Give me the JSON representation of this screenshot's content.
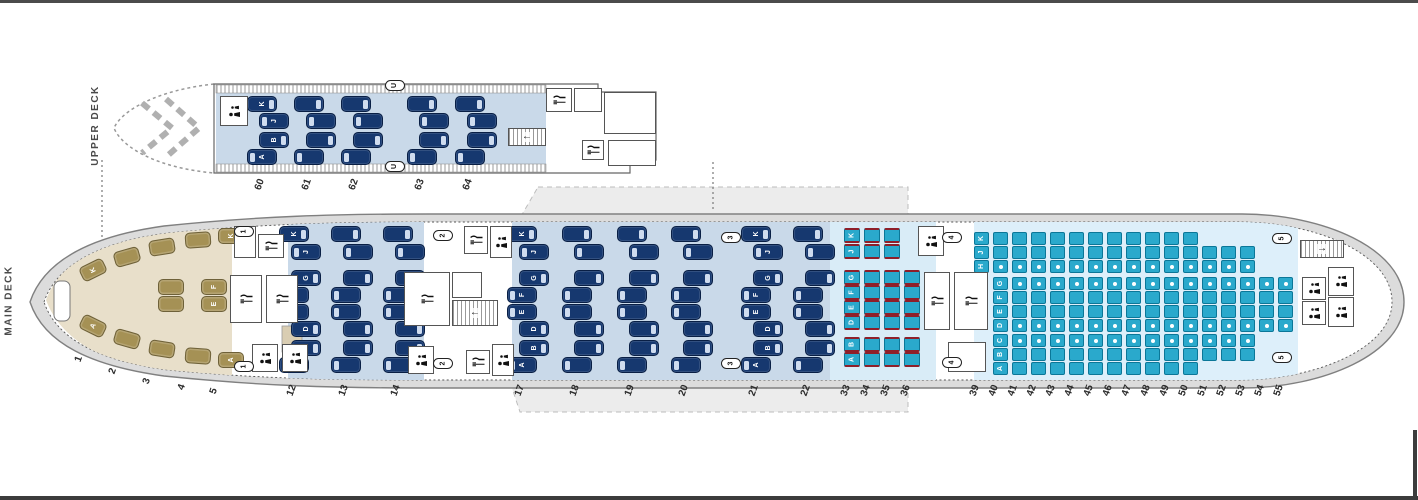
{
  "artifact_bars": {
    "top": true,
    "bottom": true,
    "right_edge": true
  },
  "seatmap": {
    "upper_deck": {
      "label": "UPPER DECK",
      "business": {
        "cabin": "Business",
        "rows": [
          60,
          61,
          62,
          63,
          64
        ],
        "letter_row": 60,
        "blocks": [
          {
            "position": "top",
            "letters": [
              "K",
              "J"
            ]
          },
          {
            "position": "bottom",
            "letters": [
              "B",
              "A"
            ]
          }
        ]
      }
    },
    "main_deck": {
      "label": "MAIN DECK",
      "first": {
        "cabin": "First",
        "rows": [
          1,
          2,
          3,
          4,
          5
        ],
        "window_top_letter": "K",
        "window_bottom_letter": "A",
        "middle_letters": [
          "F",
          "E"
        ],
        "middle_pair_rows": [
          4,
          5
        ]
      },
      "business_front": {
        "cabin": "Business",
        "rows": [
          12,
          13,
          14
        ],
        "letter_rows": [
          12
        ],
        "blocks": [
          {
            "position": "top",
            "letters": [
              "K",
              "J"
            ]
          },
          {
            "position": "middle",
            "letters": [
              "G",
              "F",
              "E",
              "D"
            ]
          },
          {
            "position": "bottom",
            "letters": [
              "B",
              "A"
            ]
          }
        ]
      },
      "business_mid": {
        "cabin": "Business",
        "rows": [
          17,
          18,
          19,
          20,
          21,
          22
        ],
        "letter_rows": [
          17,
          21
        ],
        "blocks": [
          {
            "position": "top",
            "letters": [
              "K",
              "J"
            ]
          },
          {
            "position": "middle",
            "letters": [
              "G",
              "F",
              "E",
              "D"
            ]
          },
          {
            "position": "bottom",
            "letters": [
              "B",
              "A"
            ]
          }
        ]
      },
      "premium_economy": {
        "cabin": "Premium Economy",
        "letter_row": 33,
        "blocks": [
          {
            "position": "top",
            "letters": [
              "K",
              "J"
            ],
            "rows": [
              33,
              34,
              35
            ]
          },
          {
            "position": "middle",
            "letters": [
              "G",
              "F",
              "E",
              "D"
            ],
            "rows": [
              33,
              34,
              35,
              36
            ]
          },
          {
            "position": "bottom",
            "letters": [
              "B",
              "A"
            ],
            "rows": [
              33,
              34,
              35,
              36
            ]
          }
        ]
      },
      "economy": {
        "cabin": "Economy",
        "blocks": [
          {
            "position": "top",
            "letters": [
              "K",
              "J",
              "H"
            ],
            "letter_row": 39,
            "full_rows": [
              40,
              41,
              42,
              43,
              44,
              45,
              46,
              47,
              48,
              49,
              50
            ],
            "reduced_rows": [
              51,
              52,
              53
            ],
            "reduced_letters": [
              "J",
              "H"
            ],
            "aisle_dot_letters": [
              "H"
            ]
          },
          {
            "position": "middle",
            "letters": [
              "G",
              "F",
              "E",
              "D"
            ],
            "letter_row": 40,
            "full_rows": [
              41,
              42,
              43,
              44,
              45,
              46,
              47,
              48,
              49,
              50,
              51,
              52,
              53,
              54,
              55
            ],
            "reduced_rows": [],
            "reduced_letters": [],
            "aisle_dot_letters": [
              "G",
              "D"
            ]
          },
          {
            "position": "bottom",
            "letters": [
              "C",
              "B",
              "A"
            ],
            "letter_row": 40,
            "full_rows": [
              41,
              42,
              43,
              44,
              45,
              46,
              47,
              48,
              49,
              50
            ],
            "reduced_rows": [
              51,
              52,
              53
            ],
            "reduced_letters": [
              "C",
              "B"
            ],
            "aisle_dot_letters": [
              "C"
            ]
          }
        ]
      }
    },
    "doors": [
      {
        "label": "1"
      },
      {
        "label": "1"
      },
      {
        "label": "2"
      },
      {
        "label": "2"
      },
      {
        "label": "3"
      },
      {
        "label": "3"
      },
      {
        "label": "4"
      },
      {
        "label": "4"
      },
      {
        "label": "5"
      },
      {
        "label": "5"
      },
      {
        "label": "U"
      },
      {
        "label": "U"
      }
    ],
    "icons": {
      "galley": "fork-knife-icon",
      "lavatory": "person-icon",
      "stairs": "staircase-icon"
    },
    "colors": {
      "economy_seat": "#2aa9cc",
      "economy_seat_border": "#0b7798",
      "premium_headrest": "#8e1f2a",
      "business_seat": "#16386f",
      "first_seat": "#a59155",
      "cabin_business_bg": "#c9d9e9",
      "cabin_premium_bg": "#d9ecf7",
      "cabin_economy_bg": "#ddeffa",
      "cabin_first_bg": "#e8dfca",
      "fuselage_ring": "#dcdcdc",
      "wing_shadow": "#ececec"
    }
  }
}
